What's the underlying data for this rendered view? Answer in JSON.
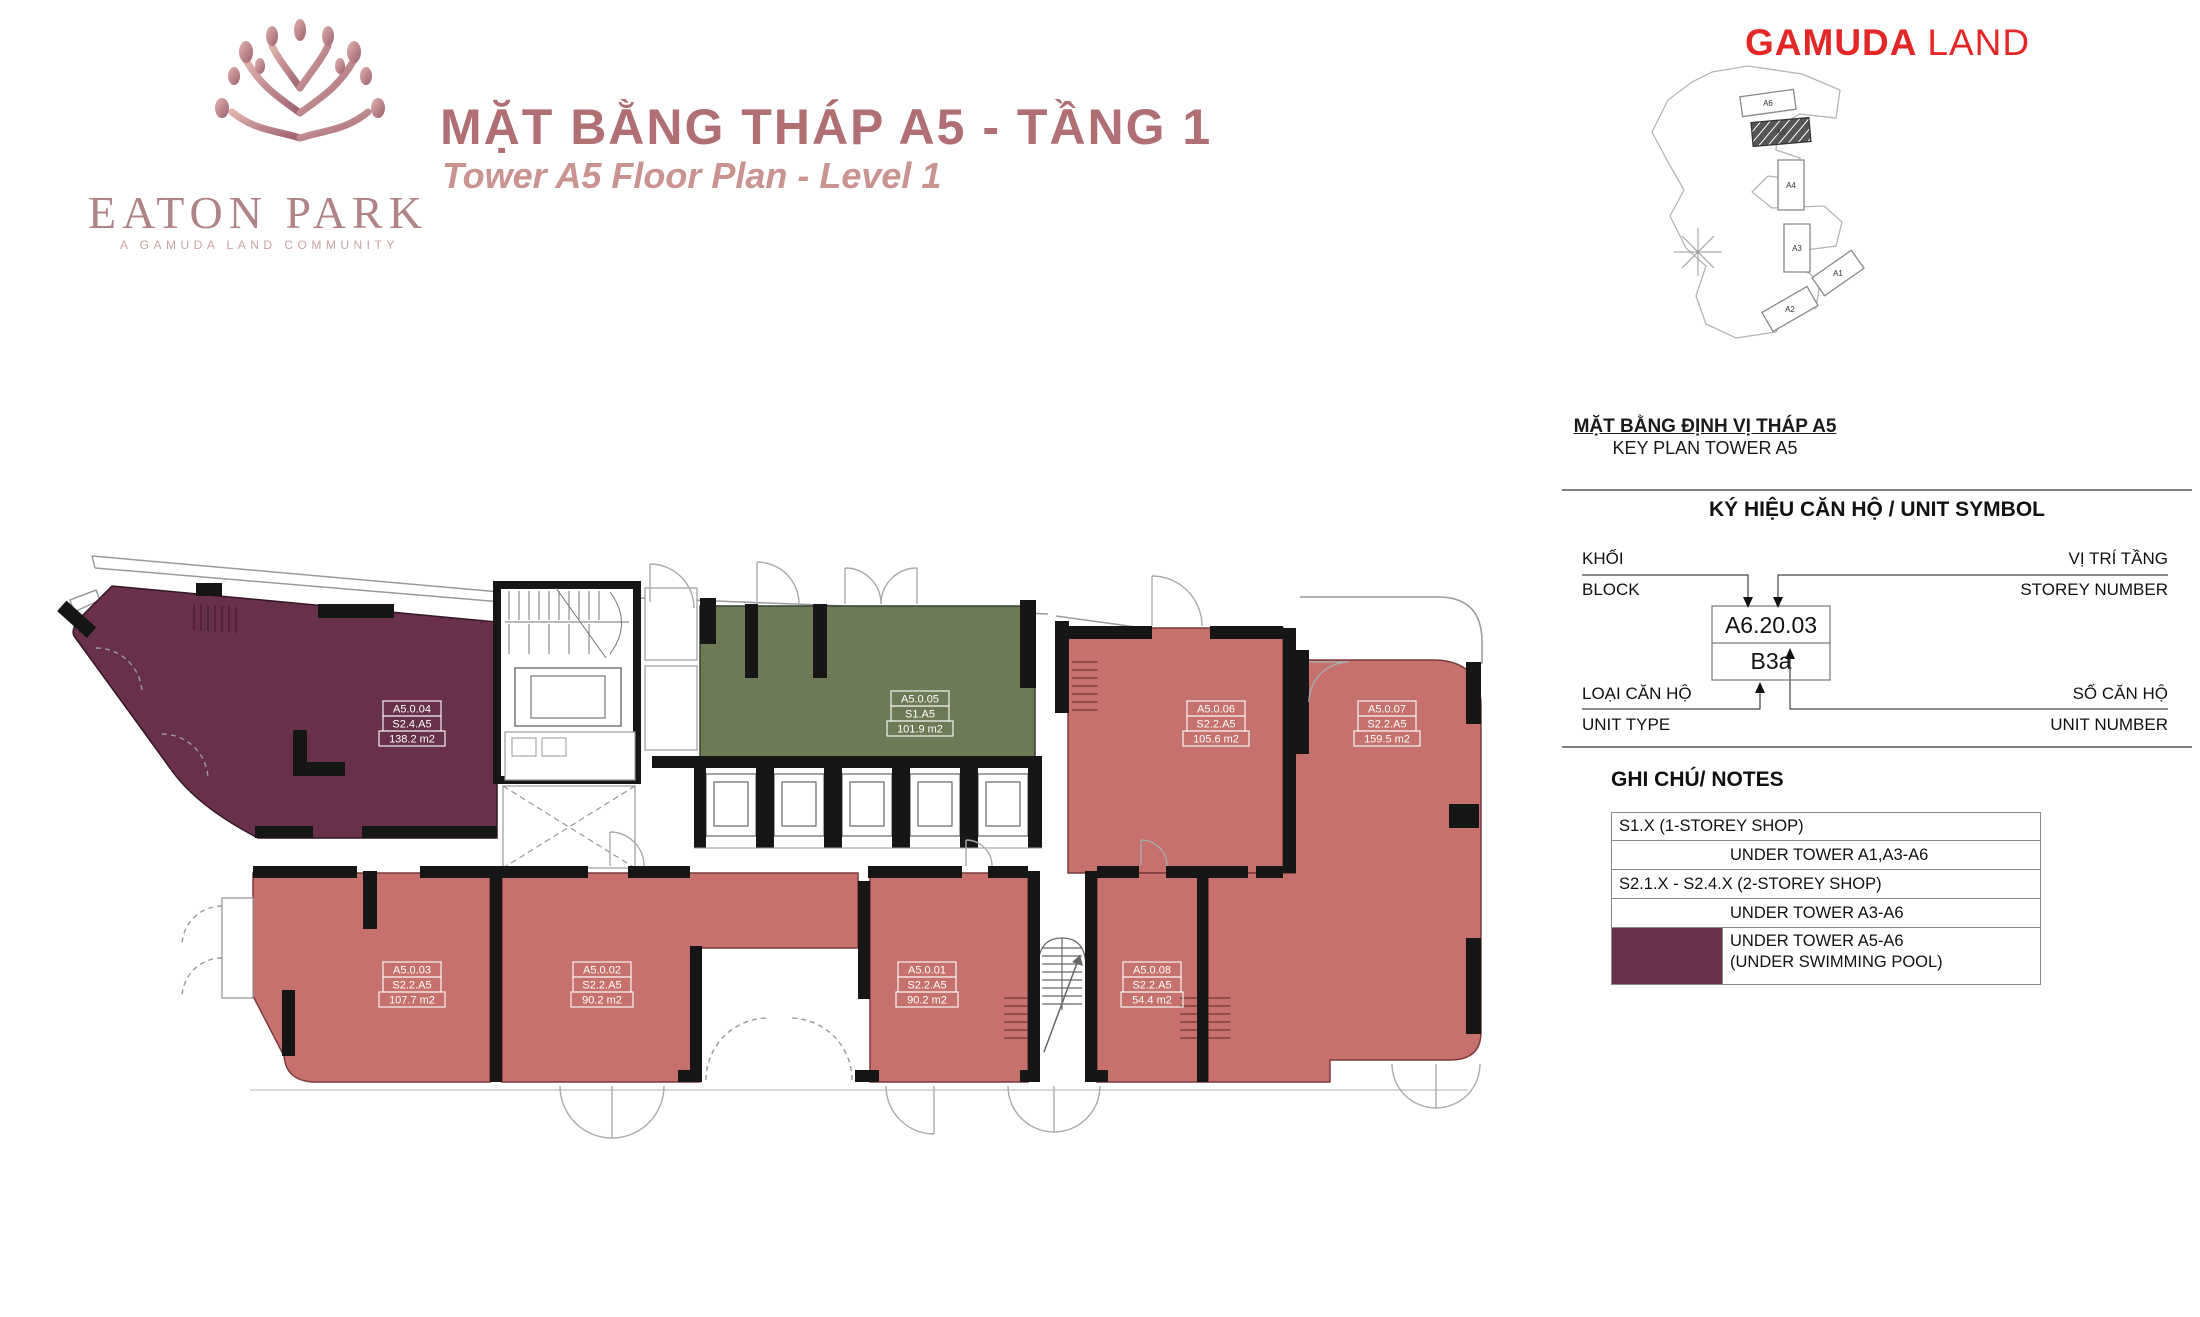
{
  "header": {
    "logo": {
      "brand": "EATON PARK",
      "tagline": "A GAMUDA LAND COMMUNITY"
    },
    "title_vi": "MẶT BẰNG THÁP A5 - TẦNG 1",
    "title_en": "Tower A5 Floor Plan - Level 1",
    "developer": {
      "part1": "GAMUDA",
      "part2": "LAND"
    }
  },
  "key_plan": {
    "caption_vi": "MẶT BẰNG ĐỊNH VỊ THÁP A5",
    "caption_en": "KEY PLAN TOWER A5",
    "towers": {
      "a6": "A6",
      "a5": "A5",
      "a4": "A4",
      "a3": "A3",
      "a1": "A1",
      "a2": "A2"
    }
  },
  "unit_symbol": {
    "heading": "KÝ HIỆU CĂN HỘ / UNIT SYMBOL",
    "block_vi": "KHỐI",
    "block_en": "BLOCK",
    "storey_vi": "VỊ TRÍ TẦNG",
    "storey_en": "STOREY NUMBER",
    "unit_type_vi": "LOẠI CĂN HỘ",
    "unit_type_en": "UNIT TYPE",
    "unit_number_vi": "SỐ CĂN HỘ",
    "unit_number_en": "UNIT NUMBER",
    "example_code": "A6.20.03",
    "example_type": "B3a"
  },
  "notes": {
    "heading": "GHI CHÚ/ NOTES",
    "row1": "S1.X (1-STOREY SHOP)",
    "row2": "UNDER TOWER A1,A3-A6",
    "row3": "S2.1.X - S2.4.X (2-STOREY SHOP)",
    "row4": "UNDER TOWER A3-A6",
    "row5a": "UNDER TOWER A5-A6",
    "row5b": "(UNDER SWIMMING POOL)"
  },
  "plan": {
    "colors": {
      "shop_1storey": "#6d7a57",
      "shop_2storey": "#c6716e",
      "under_pool": "#68304a",
      "wall": "#161616"
    },
    "units": [
      {
        "id": "A5.0.04",
        "type": "S2.4.A5",
        "area": "138.2 m2",
        "color": "#68304a"
      },
      {
        "id": "A5.0.05",
        "type": "S1.A5",
        "area": "101.9 m2",
        "color": "#6d7a57"
      },
      {
        "id": "A5.0.06",
        "type": "S2.2.A5",
        "area": "105.6 m2",
        "color": "#c6716e"
      },
      {
        "id": "A5.0.07",
        "type": "S2.2.A5",
        "area": "159.5 m2",
        "color": "#c6716e"
      },
      {
        "id": "A5.0.03",
        "type": "S2.2.A5",
        "area": "107.7 m2",
        "color": "#c6716e"
      },
      {
        "id": "A5.0.02",
        "type": "S2.2.A5",
        "area": "90.2 m2",
        "color": "#c6716e"
      },
      {
        "id": "A5.0.01",
        "type": "S2.2.A5",
        "area": "90.2 m2",
        "color": "#c6716e"
      },
      {
        "id": "A5.0.08",
        "type": "S2.2.A5",
        "area": "54.4 m2",
        "color": "#c6716e"
      }
    ]
  }
}
